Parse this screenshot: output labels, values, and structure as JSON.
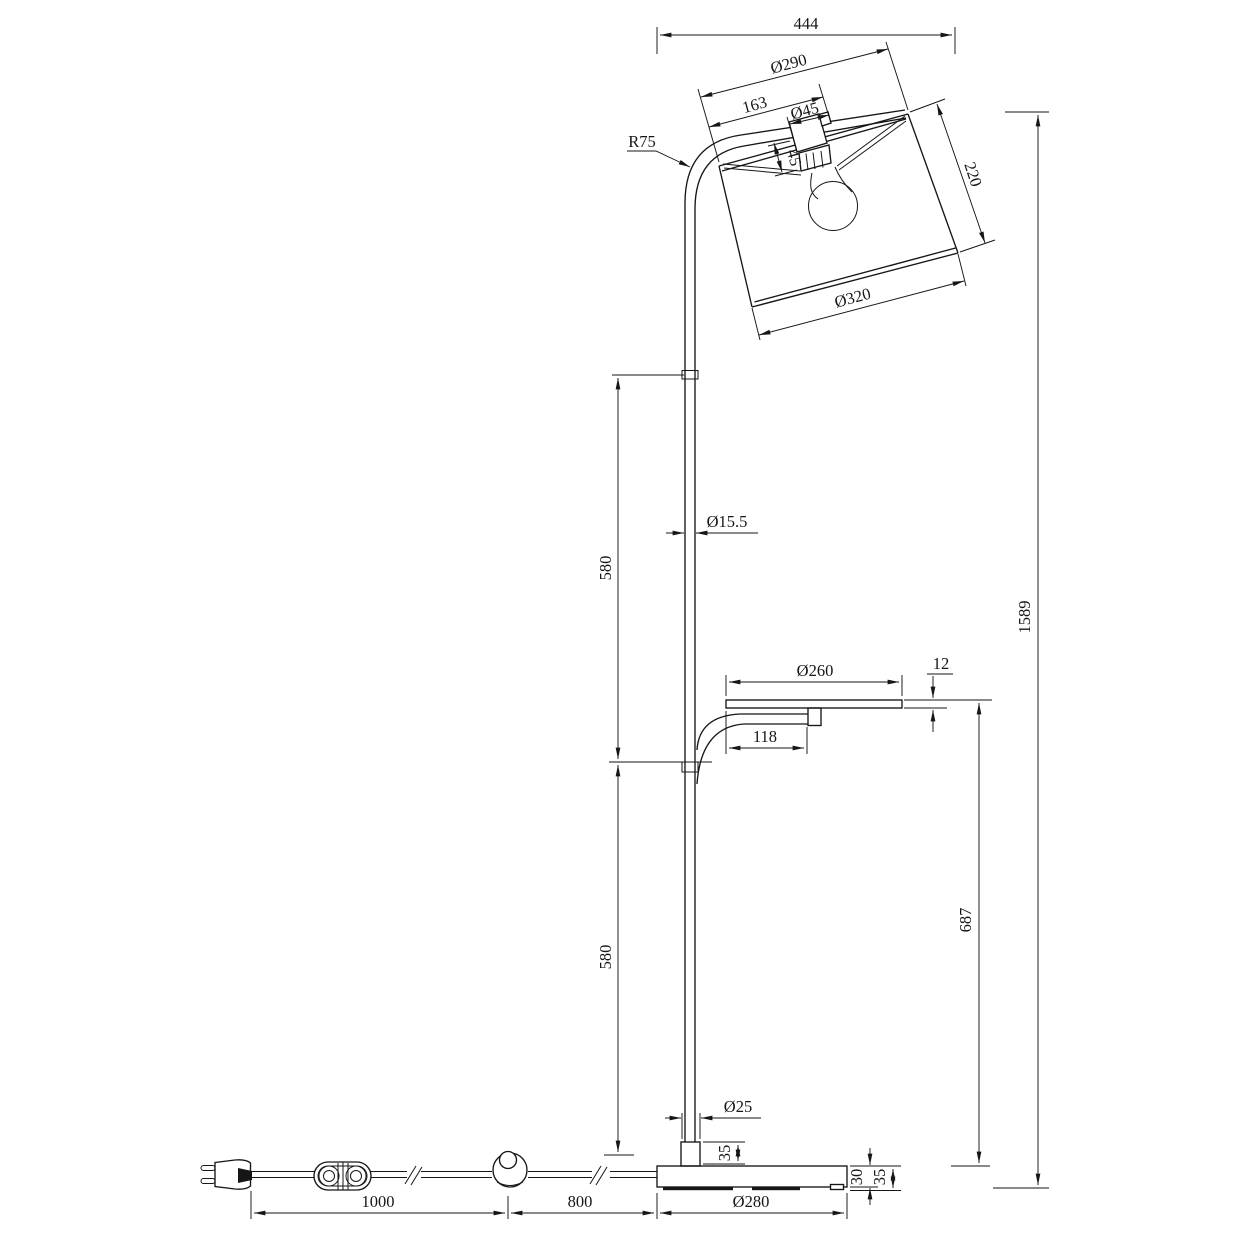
{
  "drawing": {
    "kind": "technical-dimension-drawing",
    "subject": "arched floor lamp with drum shade, reading tray, foot switch and round base",
    "units": "mm",
    "style": {
      "ink": "#161616",
      "paper": "#ffffff"
    },
    "dims": {
      "overall_width_top": "444",
      "shade_top_diameter": "Ø290",
      "socket_offset": "163",
      "socket_diameter": "Ø45",
      "socket_height": "45",
      "shade_height": "220",
      "shade_bottom_diameter": "Ø320",
      "arm_bend_radius": "R75",
      "pole_diameter": "Ø15.5",
      "pole_upper_section": "580",
      "pole_lower_section": "580",
      "tray_diameter": "Ø260",
      "tray_thickness": "12",
      "tray_arm_offset": "118",
      "tray_height": "687",
      "overall_height": "1589",
      "collar_diameter": "Ø25",
      "collar_height": "35",
      "base_plate_thickness": "30",
      "base_total_height": "35",
      "base_diameter": "Ø280",
      "cord_plug_to_switch": "1000",
      "cord_switch_to_base": "800"
    }
  }
}
